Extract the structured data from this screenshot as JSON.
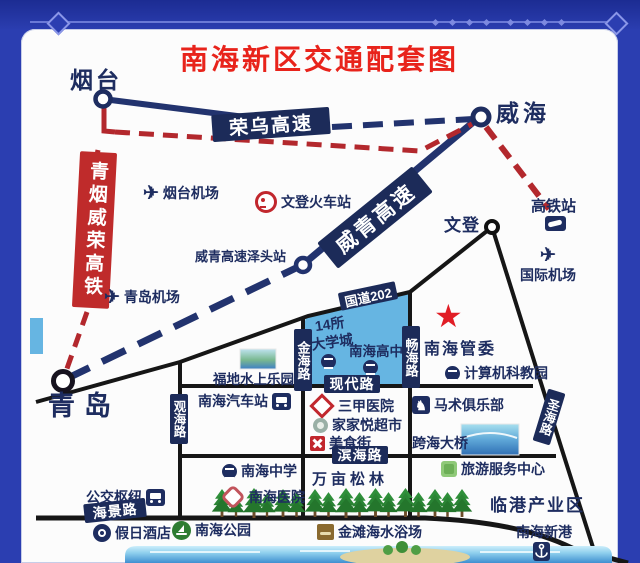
{
  "title": "南海新区交通配套图",
  "icons": {
    "plane": "✈",
    "star": "★",
    "horse": "♞"
  },
  "cities": {
    "yantai": "烟台",
    "weihai": "威海",
    "qingdao": "青岛",
    "wendeng": "文登"
  },
  "rail": {
    "line": "青烟威荣高铁",
    "gaotie": "高铁站",
    "wendeng_station": "文登火车站"
  },
  "highways": {
    "rongwu": "荣乌高速",
    "weiqing": "威青高速",
    "zetou": "威青高速泽头站",
    "g202": "国道202"
  },
  "roads": {
    "jinhai": "金海路",
    "changhai": "畅海路",
    "guanhai": "观海路",
    "shenghai": "圣海路",
    "xiandai": "现代路",
    "binhai": "滨海路",
    "haijing": "海景路"
  },
  "airports": {
    "yantai": "烟台机场",
    "qingdao": "青岛机场",
    "intl": "国际机场"
  },
  "places": {
    "daxuecheng_l1": "14所",
    "daxuecheng_l2": "大学城",
    "gaozhong": "南海高中",
    "guanwei": "南海管委",
    "jisuanji": "计算机科教园",
    "fudi": "福地水上乐园",
    "qichezhan": "南海汽车站",
    "sanjia": "三甲医院",
    "jiajiayue": "家家悦超市",
    "meishijie": "美食街",
    "mashu": "马术俱乐部",
    "kuahai": "跨海大桥",
    "lvyou": "旅游服务中心",
    "zhongxue": "南海中学",
    "yiyuan": "南海医院",
    "wanmu": "万亩松林",
    "gongjiao": "公交枢纽",
    "jiari": "假日酒店",
    "gongyuan": "南海公园",
    "jintan": "金滩海水浴场",
    "lingang": "临港产业区",
    "xingang": "南海新港"
  },
  "colors": {
    "background": "#2b3eb1",
    "card": "#fcfcfc",
    "title_red": "#e8231b",
    "navy_text": "#1e2d60",
    "box_navy": "#1c2b59",
    "rail_red": "#b3282d",
    "star_red": "#e11d25",
    "area_blue": "#66b5e2",
    "road_black": "#161616",
    "tree_green": "#2f8f3a",
    "sea_blue": "#5fb4e4",
    "sand": "#dfd2a0"
  }
}
